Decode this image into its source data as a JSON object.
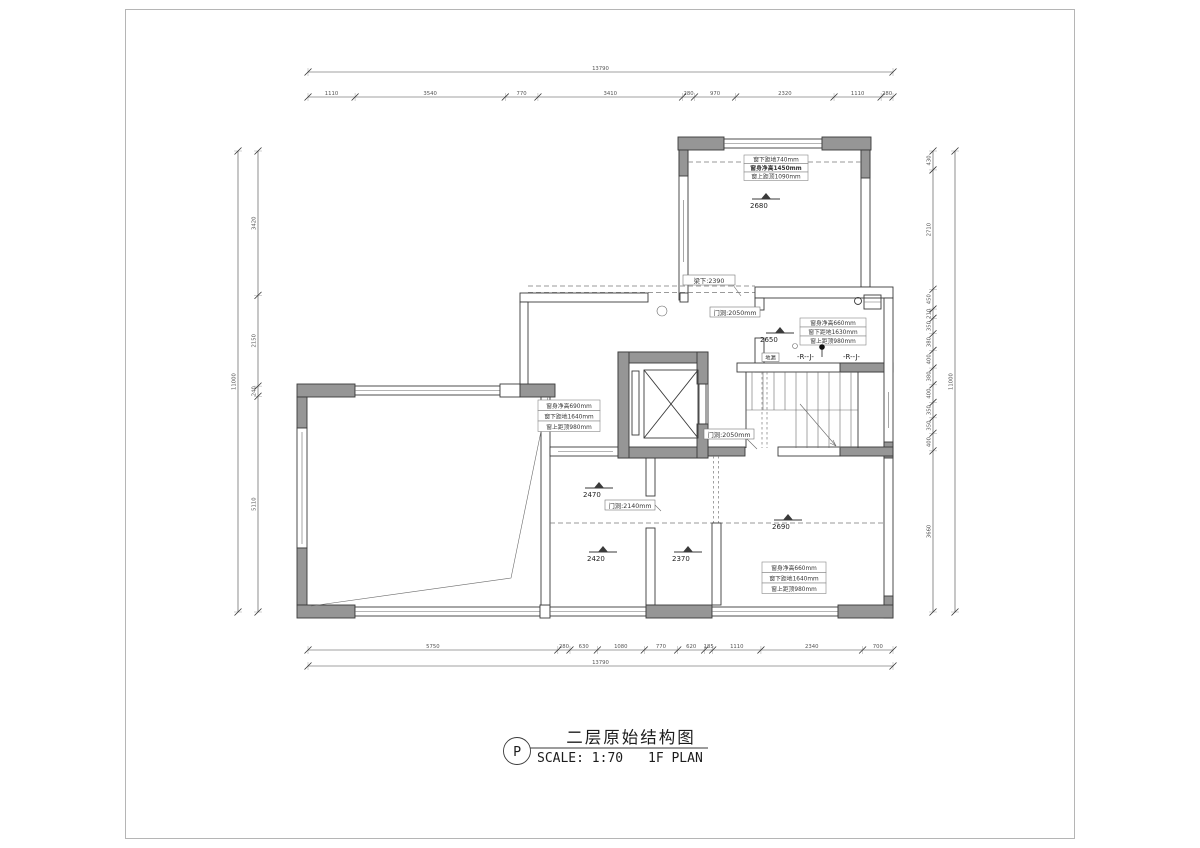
{
  "sheet": {
    "bubble": "P",
    "title": "二层原始结构图",
    "scale_label": "SCALE: 1:70",
    "plan_label": "1F PLAN"
  },
  "beam_height_labels": [
    {
      "value": "2680"
    },
    {
      "value": "2650"
    },
    {
      "value": "2470"
    },
    {
      "value": "2420"
    },
    {
      "value": "2370"
    },
    {
      "value": "2690"
    }
  ],
  "window_boxes": [
    {
      "lines": [
        "窗下距地740mm",
        "窗身净高1450mm",
        "窗上距顶1090mm"
      ]
    },
    {
      "lines": [
        "窗身净高660mm",
        "窗下距地1630mm",
        "窗上距顶980mm"
      ]
    },
    {
      "lines": [
        "窗身净高690mm",
        "窗下距地1640mm",
        "窗上距顶980mm"
      ]
    },
    {
      "lines": [
        "窗身净高660mm",
        "窗下距地1640mm",
        "窗上距顶980mm"
      ]
    }
  ],
  "leader_labels": {
    "beam_under": "梁下:2390",
    "door_a": "门洞:2050mm",
    "door_b": "门洞:2050mm",
    "door_c": "门洞:2140mm"
  },
  "misc": {
    "pipe_a": "-R--J-",
    "pipe_b": "-R--J-",
    "drain": "地漏"
  },
  "dimensions": {
    "top": {
      "total": "13790",
      "segments": [
        "1110",
        "3540",
        "770",
        "3410",
        "280",
        "970",
        "2320",
        "1110",
        "280"
      ]
    },
    "bottom": {
      "total": "13790",
      "segments": [
        "5750",
        "280",
        "630",
        "1080",
        "770",
        "620",
        "185",
        "1110",
        "2340",
        "700"
      ]
    },
    "left": {
      "total": "11000",
      "segments": [
        "3420",
        "2150",
        "240",
        "5110"
      ]
    },
    "right": {
      "total": "11000",
      "segments": [
        "430",
        "2710",
        "450",
        "210",
        "350",
        "380",
        "400",
        "380",
        "400",
        "350",
        "350",
        "400",
        "3660"
      ]
    }
  },
  "colors": {
    "wall_fill": "#969696",
    "line": "#3a3a3a",
    "dim_text": "#555555"
  }
}
